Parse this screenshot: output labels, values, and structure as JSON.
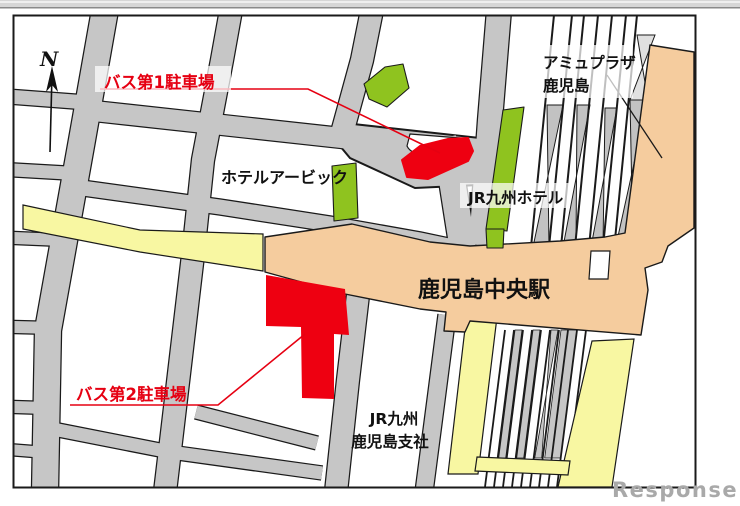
{
  "window": {
    "top_edge_bar": "window chrome edge strip"
  },
  "palette": {
    "parking_red": "#ee0011",
    "label_red": "#e60012",
    "building_green": "#8fc31f",
    "station_orange": "#f5cc9e",
    "road_gray": "#c6c6c6",
    "platform_gray": "#c2c2c2",
    "platform_light_gray": "#e0e0e0",
    "highlight_yellow": "#f8f7a2",
    "outline_black": "#1a1a1a",
    "watermark_gray": "#a9a9a9",
    "map_background": "#ffffff"
  },
  "labels": {
    "north": "N",
    "parking1": "バス第1駐車場",
    "parking2": "バス第2駐車場",
    "hotel_urbic": "ホテルアービック",
    "jr_kyushu_hotel": "JR九州ホテル",
    "amu_plaza_line1": "アミュプラザ",
    "amu_plaza_line2": "鹿児島",
    "station": "鹿児島中央駅",
    "jr_branch_line1": "JR九州",
    "jr_branch_line2": "鹿児島支社",
    "watermark": "Response."
  },
  "map_features": {
    "highlighted_areas": [
      {
        "name": "バス第1駐車場",
        "color": "#ee0011",
        "type": "bus parking lot 1"
      },
      {
        "name": "バス第2駐車場",
        "color": "#ee0011",
        "type": "bus parking lot 2"
      }
    ],
    "buildings": [
      {
        "name": "鹿児島中央駅",
        "color": "#f5cc9e",
        "type": "station"
      },
      {
        "name": "アミュプラザ鹿児島",
        "color": "#f5cc9e",
        "type": "commercial"
      },
      {
        "name": "JR九州ホテル",
        "color": "#8fc31f",
        "type": "hotel"
      },
      {
        "name": "ホテルアービック",
        "color": "#8fc31f",
        "type": "hotel"
      },
      {
        "name": "JR九州鹿児島支社",
        "color": "#ffffff",
        "type": "office block"
      }
    ],
    "railway": "multiple slanted tracks with gray platforms north and south of station",
    "roads": "gray street grid, one yellow avenue west of station, yellow lots south of station"
  }
}
